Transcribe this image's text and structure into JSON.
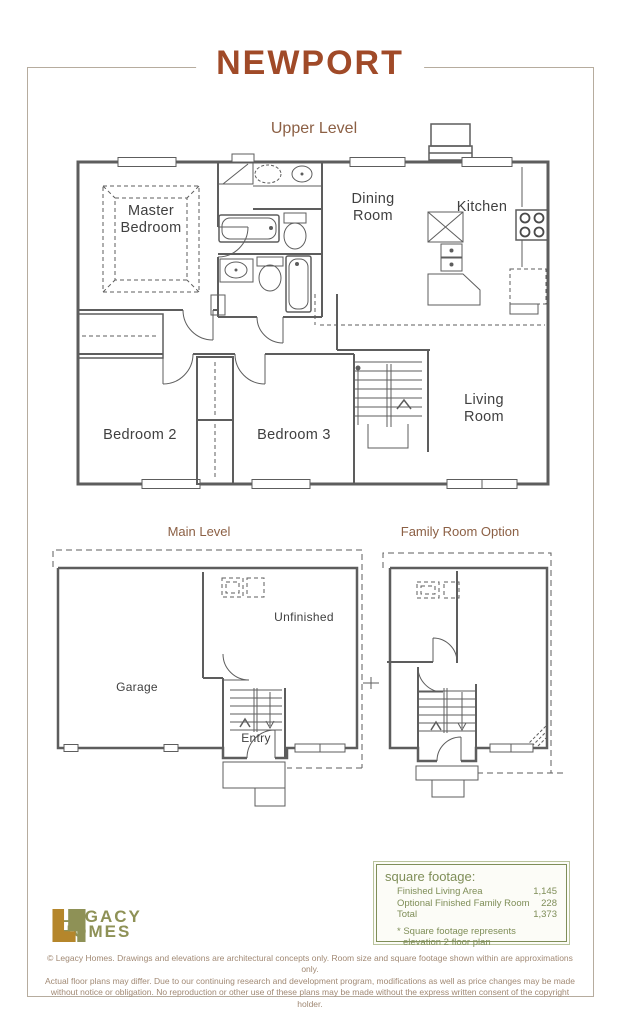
{
  "page": {
    "title": "NEWPORT"
  },
  "plans": {
    "upper": {
      "label": "Upper Level",
      "rooms": {
        "master1": "Master",
        "master2": "Bedroom",
        "dining1": "Dining",
        "dining2": "Room",
        "kitchen": "Kitchen",
        "bedroom2": "Bedroom 2",
        "bedroom3": "Bedroom 3",
        "living1": "Living",
        "living2": "Room"
      }
    },
    "main": {
      "label": "Main Level",
      "rooms": {
        "garage": "Garage",
        "unfinished": "Unfinished",
        "entry": "Entry"
      }
    },
    "family": {
      "label": "Family Room Option"
    }
  },
  "square_footage": {
    "heading": "square footage:",
    "rows": [
      {
        "label": "Finished Living Area",
        "value": "1,145"
      },
      {
        "label": "Optional Finished Family Room",
        "value": "228"
      },
      {
        "label": "Total",
        "value": "1,373"
      }
    ],
    "note1": "* Square footage represents",
    "note2": "elevation 2 floor plan"
  },
  "logo": {
    "name1": "LEGACY",
    "name2": "HOMES"
  },
  "disclaimer": {
    "line1": "© Legacy Homes. Drawings and elevations are architectural concepts only. Room size and square footage shown within are approximations only.",
    "line2": "Actual floor plans may differ. Due to our continuing research and development program, modifications as well as price changes may be made",
    "line3": "without notice or obligation. No reproduction or other use of these plans may be made without the express written consent of the copyright holder."
  },
  "colors": {
    "title": "#a04a28",
    "section_label": "#8c6045",
    "plan_line": "#5d5d5d",
    "olive_text": "#7f8e58",
    "logo_gold": "#b5862b",
    "logo_olive": "#8e9156",
    "disclaimer": "#a18974",
    "page_border": "#b6ac9e"
  }
}
